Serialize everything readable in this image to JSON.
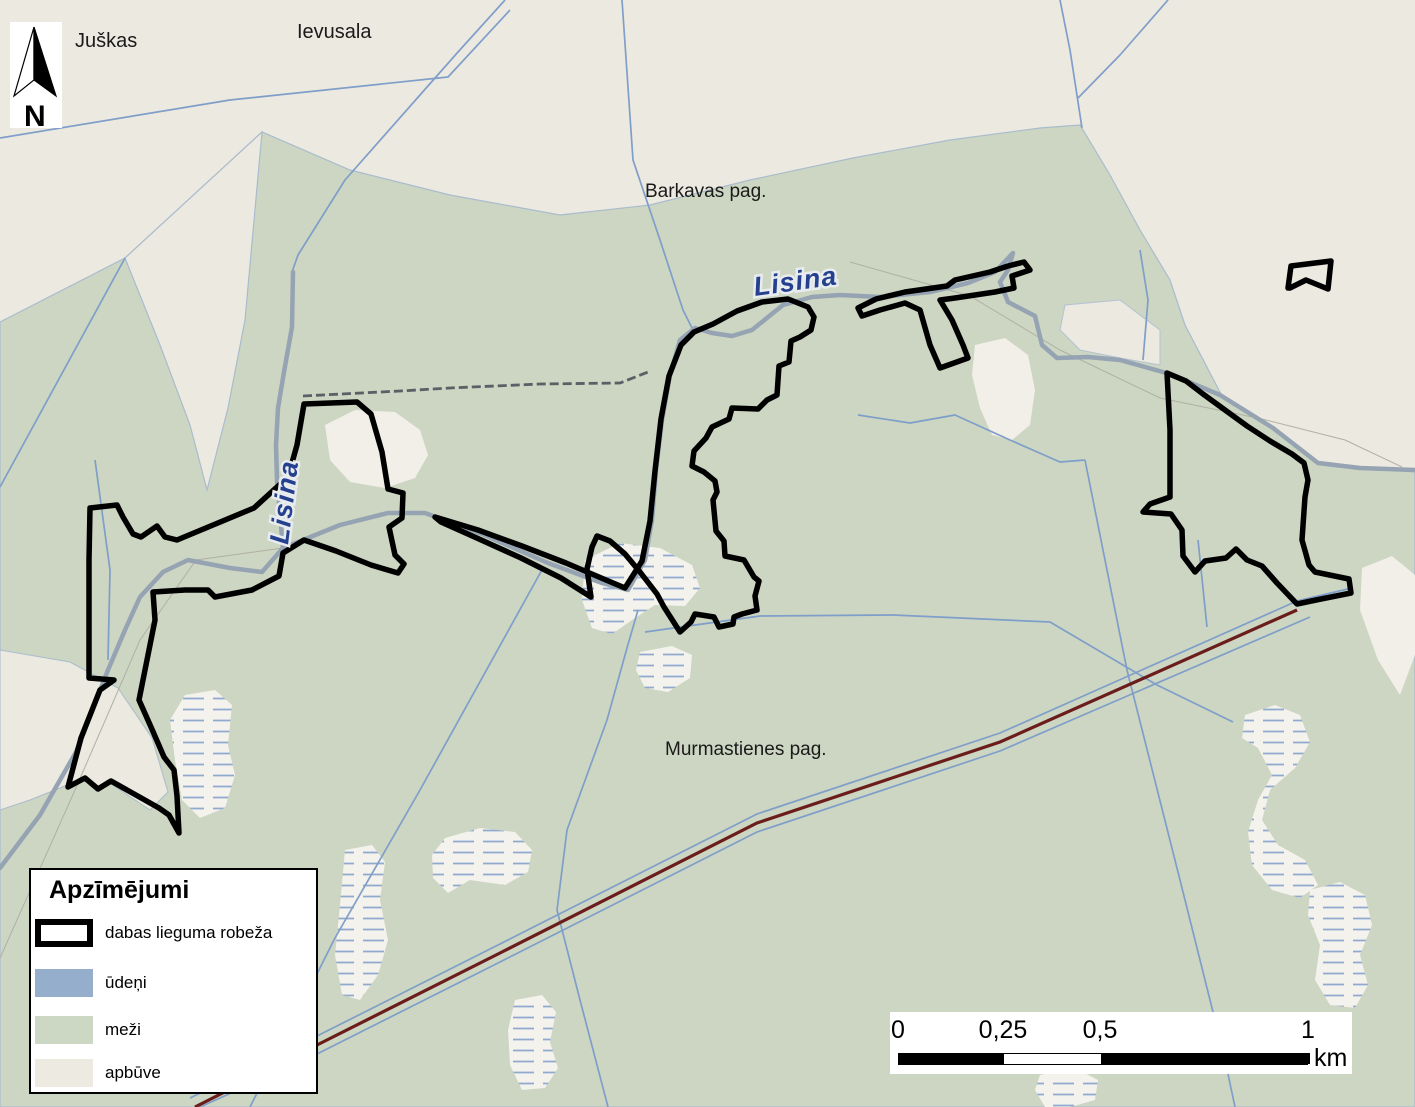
{
  "map": {
    "labels": {
      "juskas": "Juškas",
      "ievusala": "Ievusala",
      "barkavas": "Barkavas pag.",
      "murmastienes": "Murmastienes pag.",
      "river_top": "Lisina",
      "river_left": "Lisina",
      "north": "N"
    },
    "legend": {
      "title": "Apzīmējumi",
      "items": [
        {
          "label": "dabas lieguma robeža"
        },
        {
          "label": "ūdeņi"
        },
        {
          "label": "meži"
        },
        {
          "label": "apbūve"
        }
      ]
    },
    "scalebar": {
      "ticks": [
        "0",
        "0,25",
        "0,5",
        "1"
      ],
      "unit": "km"
    },
    "colors": {
      "water": "#94aecb",
      "forest": "#cdd8c4",
      "builtup": "#ece9e0",
      "bog": "#f4f2ec",
      "boundary": "#000000",
      "river": "#95a3b3",
      "ditch": "#7f9ec9",
      "road_major": "#6b1d1b",
      "road_gray": "#596066",
      "river_label": "#24408e"
    }
  }
}
